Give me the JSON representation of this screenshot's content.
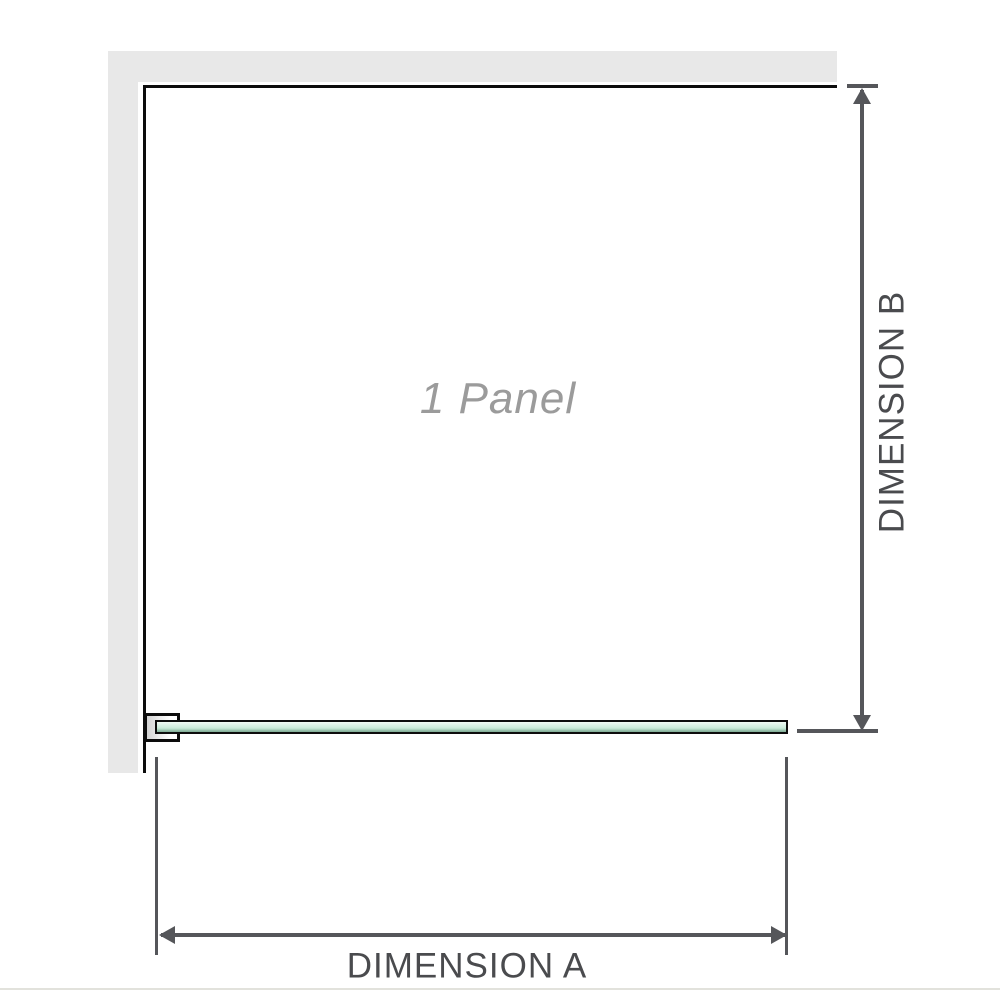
{
  "diagram": {
    "type": "shower-screen-dimension-diagram",
    "panel_label": "1 Panel",
    "dimensions": {
      "a_label": "DIMENSION A",
      "b_label": "DIMENSION B"
    },
    "icons": {
      "arrow_up": "triangle-up",
      "arrow_down": "triangle-down",
      "arrow_left": "triangle-left",
      "arrow_right": "triangle-right"
    },
    "colors": {
      "background": "#ffffff",
      "wall": "#e8e8e8",
      "panel_outline": "#0c0c0c",
      "dimension_lines": "#55565a",
      "dimension_text": "#4a4b4e",
      "panel_text": "#9b9b9b",
      "glass_light": "#f1faf5",
      "glass_mid": "#c6e9d6",
      "glass_dark": "#a9d6c0",
      "bottom_divider": "#e2e2dc"
    }
  }
}
